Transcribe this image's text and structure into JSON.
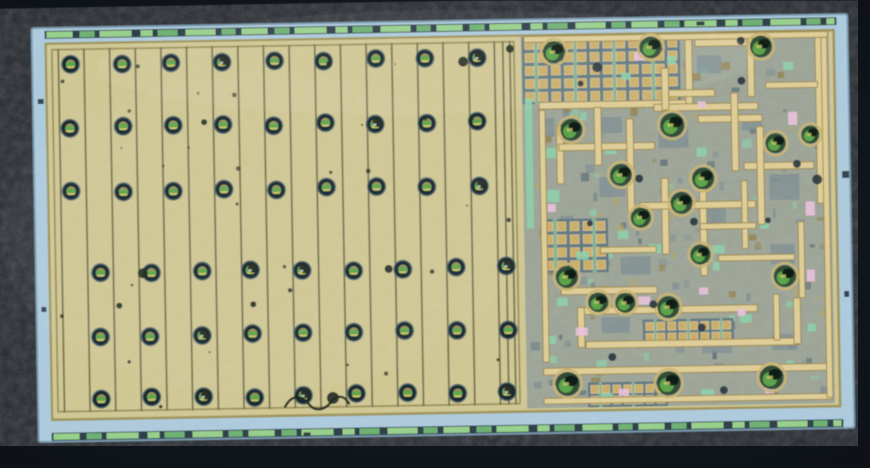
{
  "meta": {
    "description": "Photomicrograph of an integrated circuit die: left power-transistor array with vertical metal stripes and rows of round bond contacts; right analog block with gold interconnect traces, capacitor grids, green contacts and pink/teal implant patches; die bordered by light blue edge and green dashed seal ring on dark background",
    "image_type": "microscope-die-photo"
  },
  "canvas": {
    "width": 870,
    "height": 468
  },
  "palette": {
    "bg": "#161d25",
    "bg_edge": "#0c1016",
    "edge_blue": "#a6c6da",
    "edge_blue_shadow": "#6e8fa6",
    "seal_green": "#8ecb82",
    "seal_green2": "#66a96a",
    "seal_gap": "#2a3a44",
    "frame_gold": "#95894f",
    "array_gold": "#cbc28a",
    "array_line": "#6b674a",
    "array_frame": "#8a7f4e",
    "pad_outer": "#3c5866",
    "pad_ring": "#18262e",
    "pad_core": "#8a8a55",
    "pad_green": "#55a046",
    "pad_yellow": "#bec163",
    "pad_low": "#2c4632",
    "right_base": "#a2a78d",
    "right_tint": "#7d8d94",
    "slate": "#6f8089",
    "slate_dark": "#4b5e68",
    "teal": "#81cfa4",
    "teal_light": "#9adfc0",
    "gold": "#cfb97a",
    "gold_hi": "#ead9a2",
    "gold_dark": "#8b7746",
    "cap_cell": "#c6a660",
    "cap_gap": "#5c7078",
    "cap_green": "#7fae8e",
    "pink": "#e6bcd9",
    "dark": "#222f38",
    "olive": "#a89f67",
    "defect": "#1d2520",
    "glint": "#cdd6d2",
    "ring_gold": "#c4ad67",
    "rc_fill": "#2b4530",
    "rc_green": "#549a43",
    "rc_dark": "#0e1a12"
  },
  "die": {
    "x": 36,
    "y": 22,
    "w": 814,
    "h": 412,
    "rotation": -1,
    "cx": 443,
    "cy": 228
  },
  "interior": {
    "x": 48,
    "y": 36,
    "w": 790,
    "h": 378
  },
  "seal": {
    "top_y": 24,
    "bottom_y": 426,
    "height": 8,
    "x0": 50,
    "x1": 838,
    "pattern": [
      [
        26,
        0
      ],
      [
        7,
        -1
      ],
      [
        15,
        1
      ],
      [
        5,
        -1
      ],
      [
        32,
        0
      ],
      [
        9,
        -1
      ],
      [
        12,
        0
      ],
      [
        5,
        -1
      ],
      [
        20,
        1
      ],
      [
        8,
        -1
      ],
      [
        30,
        0
      ],
      [
        6,
        -1
      ],
      [
        14,
        1
      ],
      [
        6,
        -1
      ]
    ]
  },
  "left_array": {
    "x": 50,
    "y": 38,
    "w": 472,
    "h": 372,
    "frame_inset": 5,
    "line_x0": 60.5,
    "line_pitch": 25.65,
    "line_count": 18,
    "extra_lines": [
      505,
      512
    ],
    "rows_top": [
      58,
      122,
      186
    ],
    "rows_bottom": [
      268,
      330,
      393
    ],
    "cols_top_x0": 73.2,
    "cols_bottom_x0": 98.6,
    "col_pitch": 50.8,
    "col_count": 9,
    "pad_radius": 8.4,
    "damaged": [
      [
        0,
        3
      ],
      [
        0,
        8
      ],
      [
        1,
        6
      ],
      [
        2,
        8
      ],
      [
        3,
        3
      ],
      [
        3,
        4
      ],
      [
        3,
        8
      ],
      [
        4,
        2
      ],
      [
        5,
        2
      ],
      [
        5,
        4
      ],
      [
        5,
        8
      ]
    ],
    "blobs": [
      [
        142,
        268,
        5
      ],
      [
        466,
        62,
        5
      ],
      [
        513,
        50,
        4
      ],
      [
        252,
        301,
        3
      ],
      [
        332,
        62,
        3
      ],
      [
        118,
        300,
        3
      ],
      [
        388,
        268,
        4
      ],
      [
        330,
        396,
        6
      ],
      [
        206,
        118,
        3
      ]
    ],
    "squiggle": "M282,404 c8,-14 18,-10 24,-2 c6,8 16,6 22,-2 c6,-8 14,-6 18,2",
    "speck_count": 30
  },
  "right_block": {
    "x": 524,
    "y": 38,
    "w": 308,
    "h": 372,
    "cap_grids": [
      {
        "x": 528,
        "y": 42,
        "cols": 12,
        "rows": 5,
        "cell": 9,
        "gap": 4
      },
      {
        "x": 544,
        "y": 224,
        "cols": 5,
        "rows": 4,
        "cell": 9,
        "gap": 4
      },
      {
        "x": 644,
        "y": 326,
        "cols": 8,
        "rows": 2,
        "cell": 8,
        "gap": 3
      },
      {
        "x": 588,
        "y": 388,
        "cols": 7,
        "rows": 2,
        "cell": 8,
        "gap": 3
      }
    ],
    "traces": [
      [
        541,
        104,
        148,
        7
      ],
      [
        688,
        44,
        7,
        68
      ],
      [
        656,
        108,
        104,
        7
      ],
      [
        698,
        44,
        58,
        7
      ],
      [
        750,
        44,
        7,
        58
      ],
      [
        664,
        72,
        7,
        42
      ],
      [
        671,
        94,
        46,
        7
      ],
      [
        818,
        42,
        7,
        168
      ],
      [
        768,
        88,
        52,
        6
      ],
      [
        700,
        120,
        64,
        7
      ],
      [
        733,
        98,
        7,
        78
      ],
      [
        745,
        168,
        70,
        7
      ],
      [
        758,
        132,
        7,
        98
      ],
      [
        558,
        128,
        7,
        58
      ],
      [
        560,
        146,
        96,
        7
      ],
      [
        596,
        110,
        7,
        58
      ],
      [
        628,
        122,
        7,
        94
      ],
      [
        662,
        182,
        7,
        76
      ],
      [
        700,
        184,
        7,
        96
      ],
      [
        640,
        206,
        116,
        7
      ],
      [
        541,
        112,
        6,
        252
      ],
      [
        560,
        290,
        96,
        7
      ],
      [
        576,
        310,
        180,
        7
      ],
      [
        576,
        310,
        7,
        40
      ],
      [
        584,
        344,
        214,
        7
      ],
      [
        792,
        304,
        7,
        46
      ],
      [
        541,
        370,
        288,
        7
      ],
      [
        541,
        400,
        288,
        6
      ],
      [
        527,
        38,
        304,
        6
      ],
      [
        742,
        186,
        6,
        68
      ],
      [
        798,
        228,
        6,
        76
      ],
      [
        718,
        260,
        76,
        6
      ],
      [
        600,
        250,
        56,
        6
      ],
      [
        824,
        44,
        6,
        360
      ],
      [
        700,
        228,
        56,
        6
      ],
      [
        772,
        300,
        6,
        46
      ]
    ],
    "circles": [
      [
        557,
        54,
        11
      ],
      [
        654,
        51,
        11
      ],
      [
        764,
        52,
        11
      ],
      [
        573,
        132,
        11
      ],
      [
        674,
        129,
        12
      ],
      [
        777,
        149,
        10
      ],
      [
        622,
        178,
        11
      ],
      [
        704,
        183,
        11
      ],
      [
        566,
        279,
        11
      ],
      [
        641,
        221,
        10
      ],
      [
        682,
        207,
        11
      ],
      [
        700,
        259,
        10
      ],
      [
        784,
        282,
        11
      ],
      [
        597,
        305,
        10
      ],
      [
        624,
        306,
        10
      ],
      [
        667,
        311,
        11
      ],
      [
        565,
        386,
        12
      ],
      [
        666,
        387,
        12
      ],
      [
        769,
        383,
        12
      ],
      [
        812,
        141,
        9
      ]
    ],
    "pinks": [
      [
        637,
        56,
        10,
        8
      ],
      [
        790,
        118,
        9,
        13
      ],
      [
        806,
        208,
        9,
        14
      ],
      [
        548,
        206,
        8,
        8
      ],
      [
        637,
        300,
        12,
        8
      ],
      [
        698,
        292,
        9,
        7
      ],
      [
        574,
        330,
        12,
        8
      ],
      [
        806,
        276,
        8,
        12
      ],
      [
        616,
        392,
        10,
        7
      ],
      [
        736,
        314,
        8,
        7
      ],
      [
        762,
        392,
        9,
        7
      ],
      [
        700,
        106,
        8,
        6
      ]
    ],
    "teals": [
      [
        527,
        100,
        7,
        130
      ],
      [
        545,
        150,
        14,
        10
      ],
      [
        544,
        192,
        16,
        12
      ],
      [
        606,
        148,
        12,
        9
      ],
      [
        648,
        248,
        13,
        9
      ],
      [
        712,
        250,
        12,
        8
      ],
      [
        556,
        300,
        10,
        8
      ],
      [
        738,
        320,
        12,
        8
      ],
      [
        786,
        68,
        10,
        8
      ],
      [
        698,
        152,
        10,
        9
      ],
      [
        618,
        234,
        10,
        8
      ],
      [
        576,
        254,
        12,
        8
      ],
      [
        806,
        330,
        8,
        8
      ],
      [
        670,
        60,
        9,
        8
      ],
      [
        698,
        394,
        13,
        8
      ],
      [
        598,
        396,
        12,
        7
      ],
      [
        544,
        338,
        10,
        8
      ],
      [
        760,
        226,
        9,
        8
      ],
      [
        624,
        76,
        9,
        7
      ]
    ],
    "slates": [
      [
        600,
        120,
        24,
        16
      ],
      [
        660,
        130,
        30,
        22
      ],
      [
        700,
        210,
        26,
        20
      ],
      [
        770,
        180,
        30,
        26
      ],
      [
        600,
        180,
        26,
        20
      ],
      [
        560,
        218,
        14,
        30
      ],
      [
        700,
        60,
        24,
        18
      ],
      [
        770,
        250,
        24,
        20
      ],
      [
        620,
        260,
        30,
        18
      ],
      [
        744,
        120,
        20,
        16
      ],
      [
        600,
        320,
        28,
        16
      ],
      [
        700,
        340,
        30,
        18
      ],
      [
        770,
        340,
        26,
        16
      ],
      [
        544,
        120,
        12,
        18
      ]
    ],
    "darks": [
      [
        600,
        70,
        5
      ],
      [
        744,
        86,
        4
      ],
      [
        798,
        170,
        4
      ],
      [
        694,
        226,
        4
      ],
      [
        640,
        182,
        4
      ],
      [
        590,
        226,
        3
      ],
      [
        768,
        226,
        3
      ],
      [
        700,
        332,
        4
      ],
      [
        610,
        360,
        4
      ],
      [
        818,
        186,
        5
      ],
      [
        744,
        46,
        4
      ],
      [
        583,
        86,
        3
      ],
      [
        652,
        308,
        4
      ],
      [
        721,
        395,
        4
      ]
    ],
    "scatter_count": 170
  },
  "edge_defects": [
    [
      843,
      178,
      7,
      7
    ],
    [
      843,
      298,
      5,
      6
    ],
    [
      40,
      92,
      6,
      5
    ],
    [
      40,
      300,
      5,
      5
    ],
    [
      700,
      26,
      8,
      4
    ],
    [
      300,
      430,
      7,
      4
    ]
  ]
}
